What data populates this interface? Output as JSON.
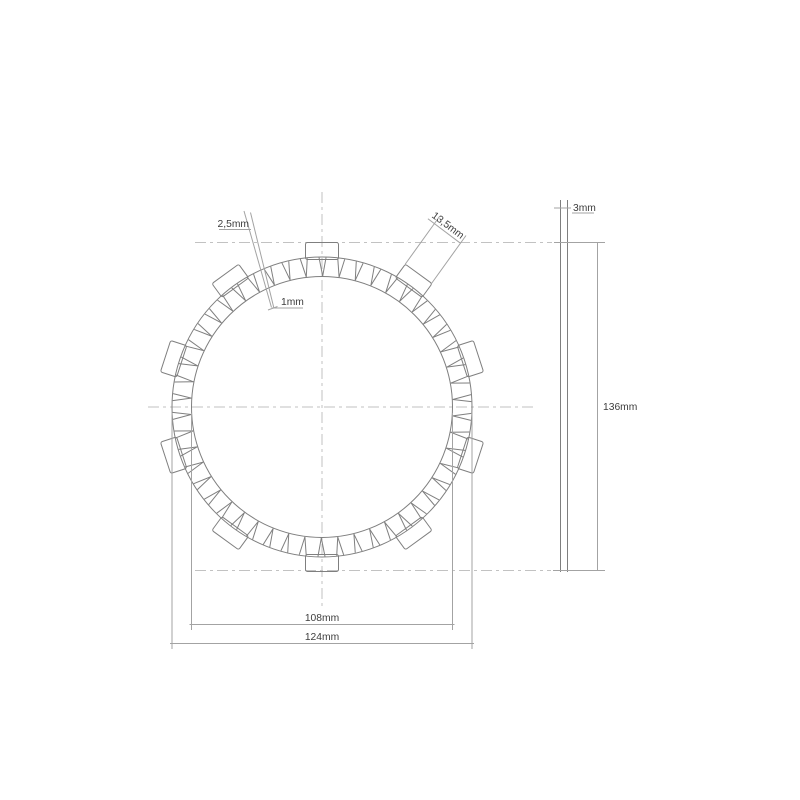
{
  "labels": {
    "groove_width_outer": "2,5mm",
    "groove_width_inner": "1mm",
    "tab_width": "13,5mm",
    "thickness": "3mm",
    "overall_height": "136mm",
    "friction_inner_diameter": "108mm",
    "outer_diameter": "124mm"
  },
  "geometry": {
    "center_x": 322,
    "center_y": 407,
    "outer_radius": 150,
    "inner_radius": 130.5,
    "tab_outer_radius": 164.5,
    "tab_inner_radius": 147.5,
    "tab_half_width": 16.5,
    "tab_count": 10,
    "tab_corner_radius": 2,
    "pad_count": 50,
    "groove_inner_offset_deg": -0.3,
    "groove_outer_offsets_deg": [
      -1.55,
      1.15
    ]
  },
  "colors": {
    "background": "#ffffff",
    "line_main": "#7f7f7f",
    "line_dim": "#a3a3a3",
    "line_dash": "#c2c2c2",
    "text": "#3d3d3d"
  }
}
